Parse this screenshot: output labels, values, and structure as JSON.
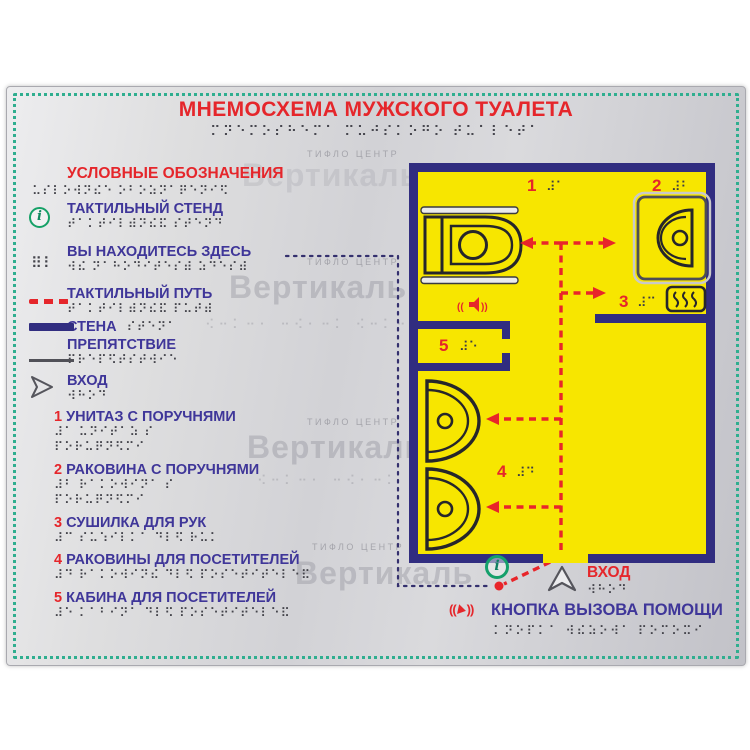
{
  "sign": {
    "title": "МНЕМОСХЕМА МУЖСКОГО ТУАЛЕТА",
    "title_braille": "⠍⠝⠑⠍⠕⠎⠓⠑⠍⠁ ⠍⠥⠚⠎⠅⠕⠛⠕ ⠞⠥⠁⠇⠑⠞⠁",
    "watermark_small": "ТИФЛО ЦЕНТР",
    "watermark_big": "Вертикаль",
    "watermark_braille": "⠪⠒⠅⠒⠂ ⠒⠪⠂⠒⠅ ⠪⠒⠅⠒",
    "colors": {
      "accent_red": "#e5262b",
      "text_purple": "#3f3699",
      "plan_yellow": "#f7e600",
      "wall_navy": "#312d80",
      "frame_teal": "#2fae8f",
      "info_green": "#14a06b"
    }
  },
  "legend": {
    "heading": "УСЛОВНЫЕ ОБОЗНАЧЕНИЯ",
    "heading_braille": "⠥⠎⠇⠕⠺⠝⠮⠑ ⠕⠃⠕⠵⠝⠁⠟⠑⠝⠊⠫",
    "items": [
      {
        "label": "ТАКТИЛЬНЫЙ СТЕНД",
        "braille": "⠞⠁⠅⠞⠊⠇⠾⠝⠮⠯ ⠎⠞⠑⠝⠙",
        "marker": "info-icon"
      },
      {
        "label": "ВЫ НАХОДИТЕСЬ ЗДЕСЬ",
        "braille": "⠺⠮ ⠝⠁⠓⠕⠙⠊⠞⠑⠎⠾ ⠵⠙⠑⠎⠾",
        "marker": "braille-dots",
        "marker_glyph": "⠿⠇"
      },
      {
        "label": "ТАКТИЛЬНЫЙ ПУТЬ",
        "braille": "⠞⠁⠅⠞⠊⠇⠾⠝⠮⠯ ⠏⠥⠞⠾",
        "marker": "red-dashed-line"
      },
      {
        "label": "СТЕНА",
        "braille": "⠎⠞⠑⠝⠁",
        "marker": "wall-bar"
      },
      {
        "label": "ПРЕПЯТСТВИЕ",
        "braille": "⠏⠗⠑⠏⠫⠞⠎⠞⠺⠊⠑",
        "marker": "thin-line"
      },
      {
        "label": "ВХОД",
        "braille": "⠺⠓⠕⠙",
        "marker": "entrance-triangle"
      }
    ],
    "numbered": [
      {
        "num": "1",
        "label": "УНИТАЗ С ПОРУЧНЯМИ",
        "braille1": "⠼⠁ ⠥⠝⠊⠞⠁⠵ ⠎",
        "braille2": "⠏⠕⠗⠥⠟⠝⠫⠍⠊"
      },
      {
        "num": "2",
        "label": "РАКОВИНА С ПОРУЧНЯМИ",
        "braille1": "⠼⠃ ⠗⠁⠅⠕⠺⠊⠝⠁ ⠎",
        "braille2": "⠏⠕⠗⠥⠟⠝⠫⠍⠊"
      },
      {
        "num": "3",
        "label": "СУШИЛКА ДЛЯ РУК",
        "braille1": "⠼⠉ ⠎⠥⠱⠊⠇⠅⠁ ⠙⠇⠫ ⠗⠥⠅"
      },
      {
        "num": "4",
        "label": "РАКОВИНЫ ДЛЯ ПОСЕТИТЕЛЕЙ",
        "braille1": "⠼⠙ ⠗⠁⠅⠕⠺⠊⠝⠮ ⠙⠇⠫ ⠏⠕⠎⠑⠞⠊⠞⠑⠇⠑⠯"
      },
      {
        "num": "5",
        "label": "КАБИНА ДЛЯ ПОСЕТИТЕЛЕЙ",
        "braille1": "⠼⠑ ⠅⠁⠃⠊⠝⠁ ⠙⠇⠫ ⠏⠕⠎⠑⠞⠊⠞⠑⠇⠑⠯"
      }
    ]
  },
  "plan": {
    "labels": [
      {
        "num": "1",
        "braille": "⠼⠁"
      },
      {
        "num": "2",
        "braille": "⠼⠃"
      },
      {
        "num": "3",
        "braille": "⠼⠉"
      },
      {
        "num": "4",
        "braille": "⠼⠙"
      },
      {
        "num": "5",
        "braille": "⠼⠑"
      }
    ],
    "entrance": {
      "label": "ВХОД",
      "braille": "⠺⠓⠕⠙"
    },
    "info_point_glyph": "i",
    "help_button": {
      "label": "КНОПКА ВЫЗОВА ПОМОЩИ",
      "braille": "⠅⠝⠕⠏⠅⠁ ⠺⠮⠵⠕⠺⠁ ⠏⠕⠍⠕⠭⠊"
    }
  }
}
